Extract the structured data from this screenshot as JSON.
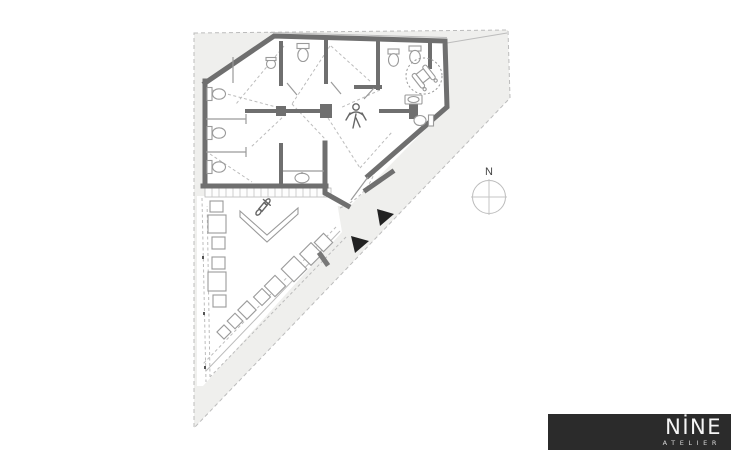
{
  "floor_plan": {
    "compass_label": "N",
    "colors": {
      "site_fill": "#efefed",
      "wall": "#6f6f6f",
      "line": "#9a9a9a",
      "light_line": "#bcbcbc",
      "marker": "#222222"
    }
  },
  "logo": {
    "title": "NİNE",
    "subtitle": "ATELIER",
    "background": "#2b2b2b",
    "text_color": "#f5f5f5"
  }
}
